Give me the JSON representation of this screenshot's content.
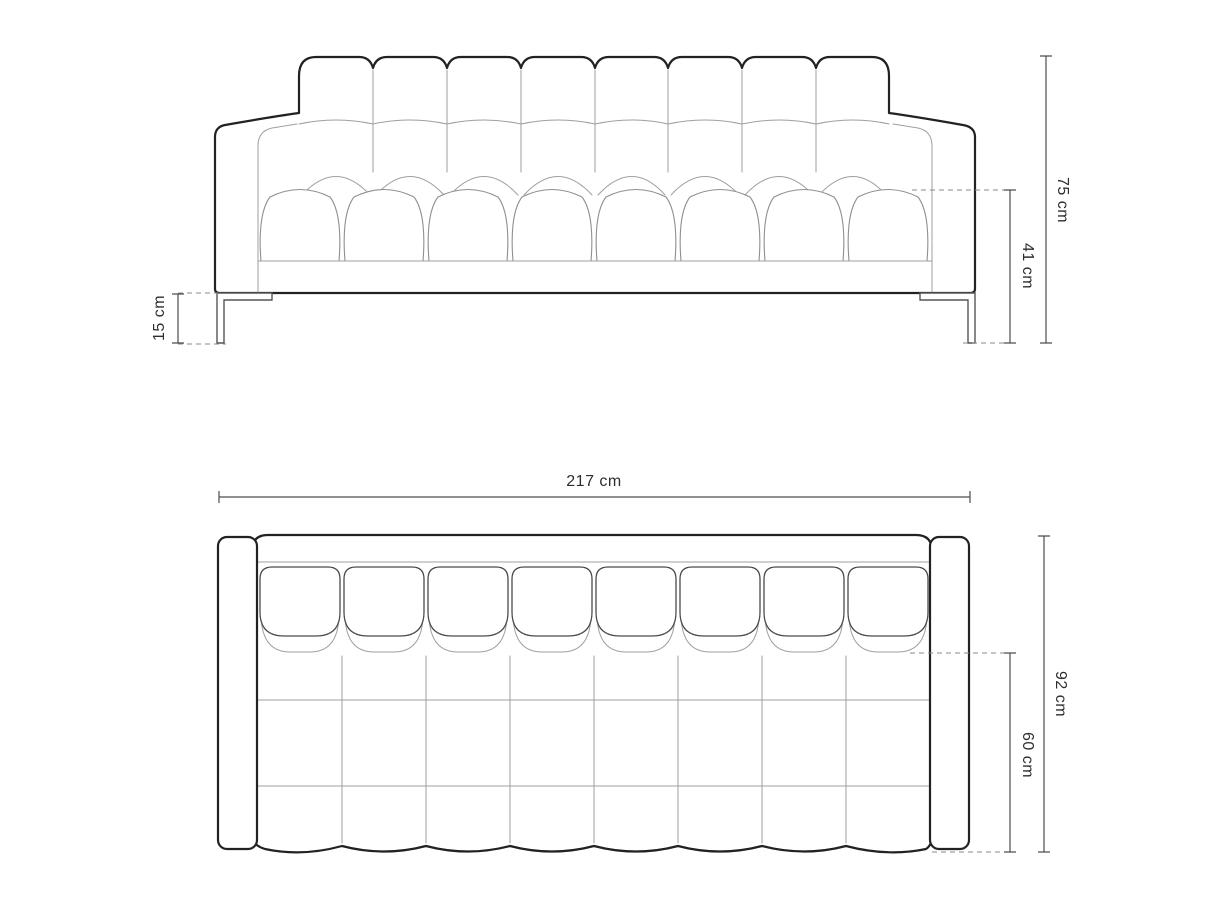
{
  "dimensions": {
    "front": {
      "overall_height": "75 cm",
      "seat_height": "41 cm",
      "leg_height": "15 cm"
    },
    "top": {
      "overall_width": "217 cm",
      "overall_depth": "92 cm",
      "seat_depth": "60 cm"
    }
  },
  "colors": {
    "background": "#ffffff",
    "outline": "#222222",
    "detail_line": "#9f9f9f",
    "dimension_line": "#4d4d4d",
    "label_text": "#2e2e2e"
  }
}
